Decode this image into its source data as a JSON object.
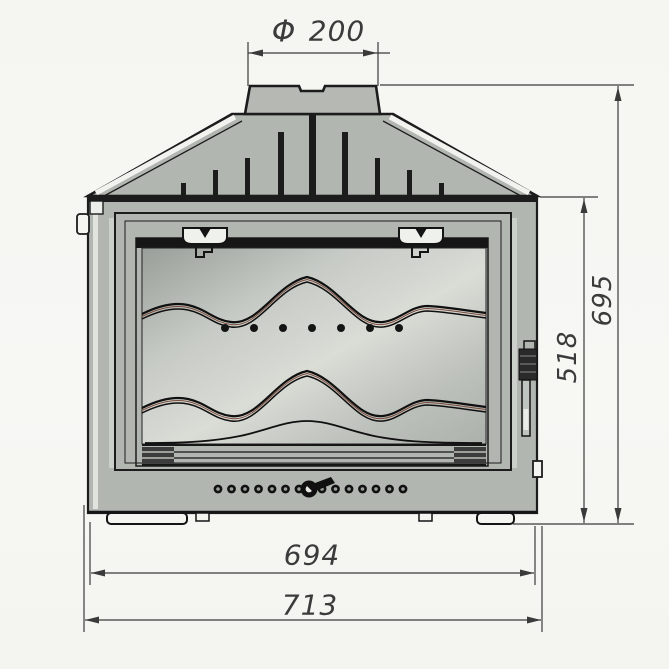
{
  "drawing_title": "fireplace-insert-front-view",
  "dimensions": {
    "flue_diameter": {
      "symbol": "Φ",
      "value": "200"
    },
    "overall_height": "695",
    "firebox_height": "518",
    "inner_width": "694",
    "overall_width": "713"
  },
  "features": {
    "vent_hole_count": 14,
    "glass_dot_count": 7,
    "cooling_fin_count": 8
  },
  "colors": {
    "paper": "#f6f6f3",
    "metal": "#b2b6b1",
    "line": "#1c1c1c",
    "dimension": "#3b3b3b",
    "glass_light": "#d6d9d4",
    "glass_dark": "#9fa49f"
  }
}
